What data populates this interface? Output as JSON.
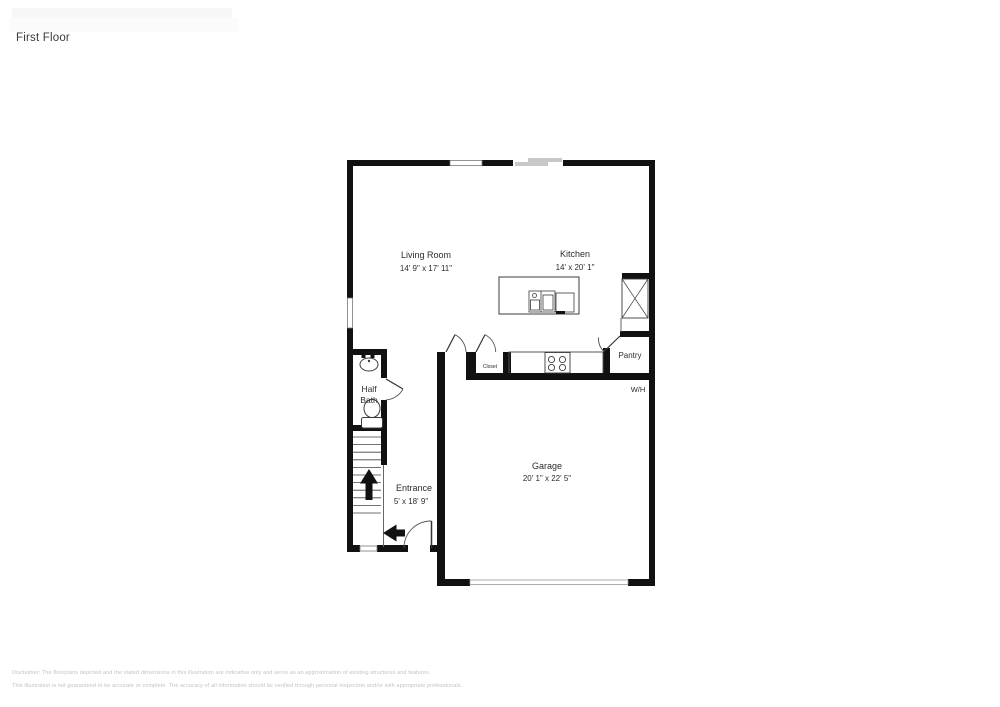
{
  "page": {
    "title": "First Floor"
  },
  "rooms": {
    "living_room": {
      "name": "Living Room",
      "dims": "14' 9\" x 17' 11\""
    },
    "kitchen": {
      "name": "Kitchen",
      "dims": "14' x 20' 1\""
    },
    "half_bath": {
      "name_line1": "Half",
      "name_line2": "Bath"
    },
    "entrance": {
      "name": "Entrance",
      "dims": "5' x 18' 9\""
    },
    "garage": {
      "name": "Garage",
      "dims": "20' 1\" x 22' 5\""
    },
    "closet": {
      "name": "Closet"
    },
    "pantry": {
      "name": "Pantry"
    },
    "water_heater": {
      "name": "W/H"
    }
  },
  "disclaimer": {
    "line1": "Disclaimer: The floorplans depicted and the stated dimensions in this illustration are indicative only and serve as an approximation of existing structures and features.",
    "line2": "This illustration is not guaranteed to be accurate or complete. The accuracy of all information should be verified through personal inspection and/or with appropriate professionals."
  },
  "colors": {
    "wall": "#111111",
    "fixture_line": "#3c3c3c",
    "door_arc": "#555555",
    "window_gray": "#c8c8c8",
    "label_text": "#2b2b2b",
    "disclaimer_text": "#c3c3c3"
  }
}
